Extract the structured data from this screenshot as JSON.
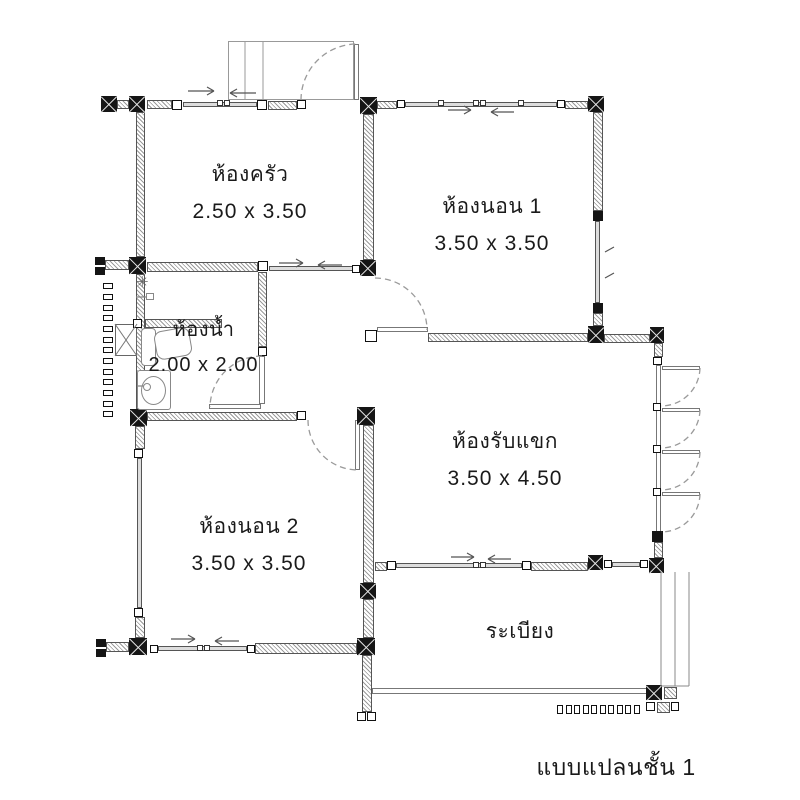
{
  "floor_plan": {
    "caption": "แบบแปลนชั้น 1",
    "rooms": [
      {
        "key": "kitchen",
        "name": "ห้องครัว",
        "size": "2.50 x 3.50"
      },
      {
        "key": "bedroom-1",
        "name": "ห้องนอน 1",
        "size": "3.50 x 3.50"
      },
      {
        "key": "bathroom",
        "name": "ห้องน้ำ",
        "size": "2.00 x 2.00"
      },
      {
        "key": "living-room",
        "name": "ห้องรับแขก",
        "size": "3.50 x 4.50"
      },
      {
        "key": "bedroom-2",
        "name": "ห้องนอน 2",
        "size": "3.50 x 3.50"
      },
      {
        "key": "balcony",
        "name": "ระเบียง",
        "size": ""
      }
    ],
    "icons": {
      "shower_drain": "✳"
    },
    "colors": {
      "wall_hatch": "#9a9a9a",
      "wall_border": "#555555",
      "column": "#151515",
      "door_arc": "#9a9a9a",
      "text": "#1a1a1a",
      "background": "#ffffff"
    }
  }
}
